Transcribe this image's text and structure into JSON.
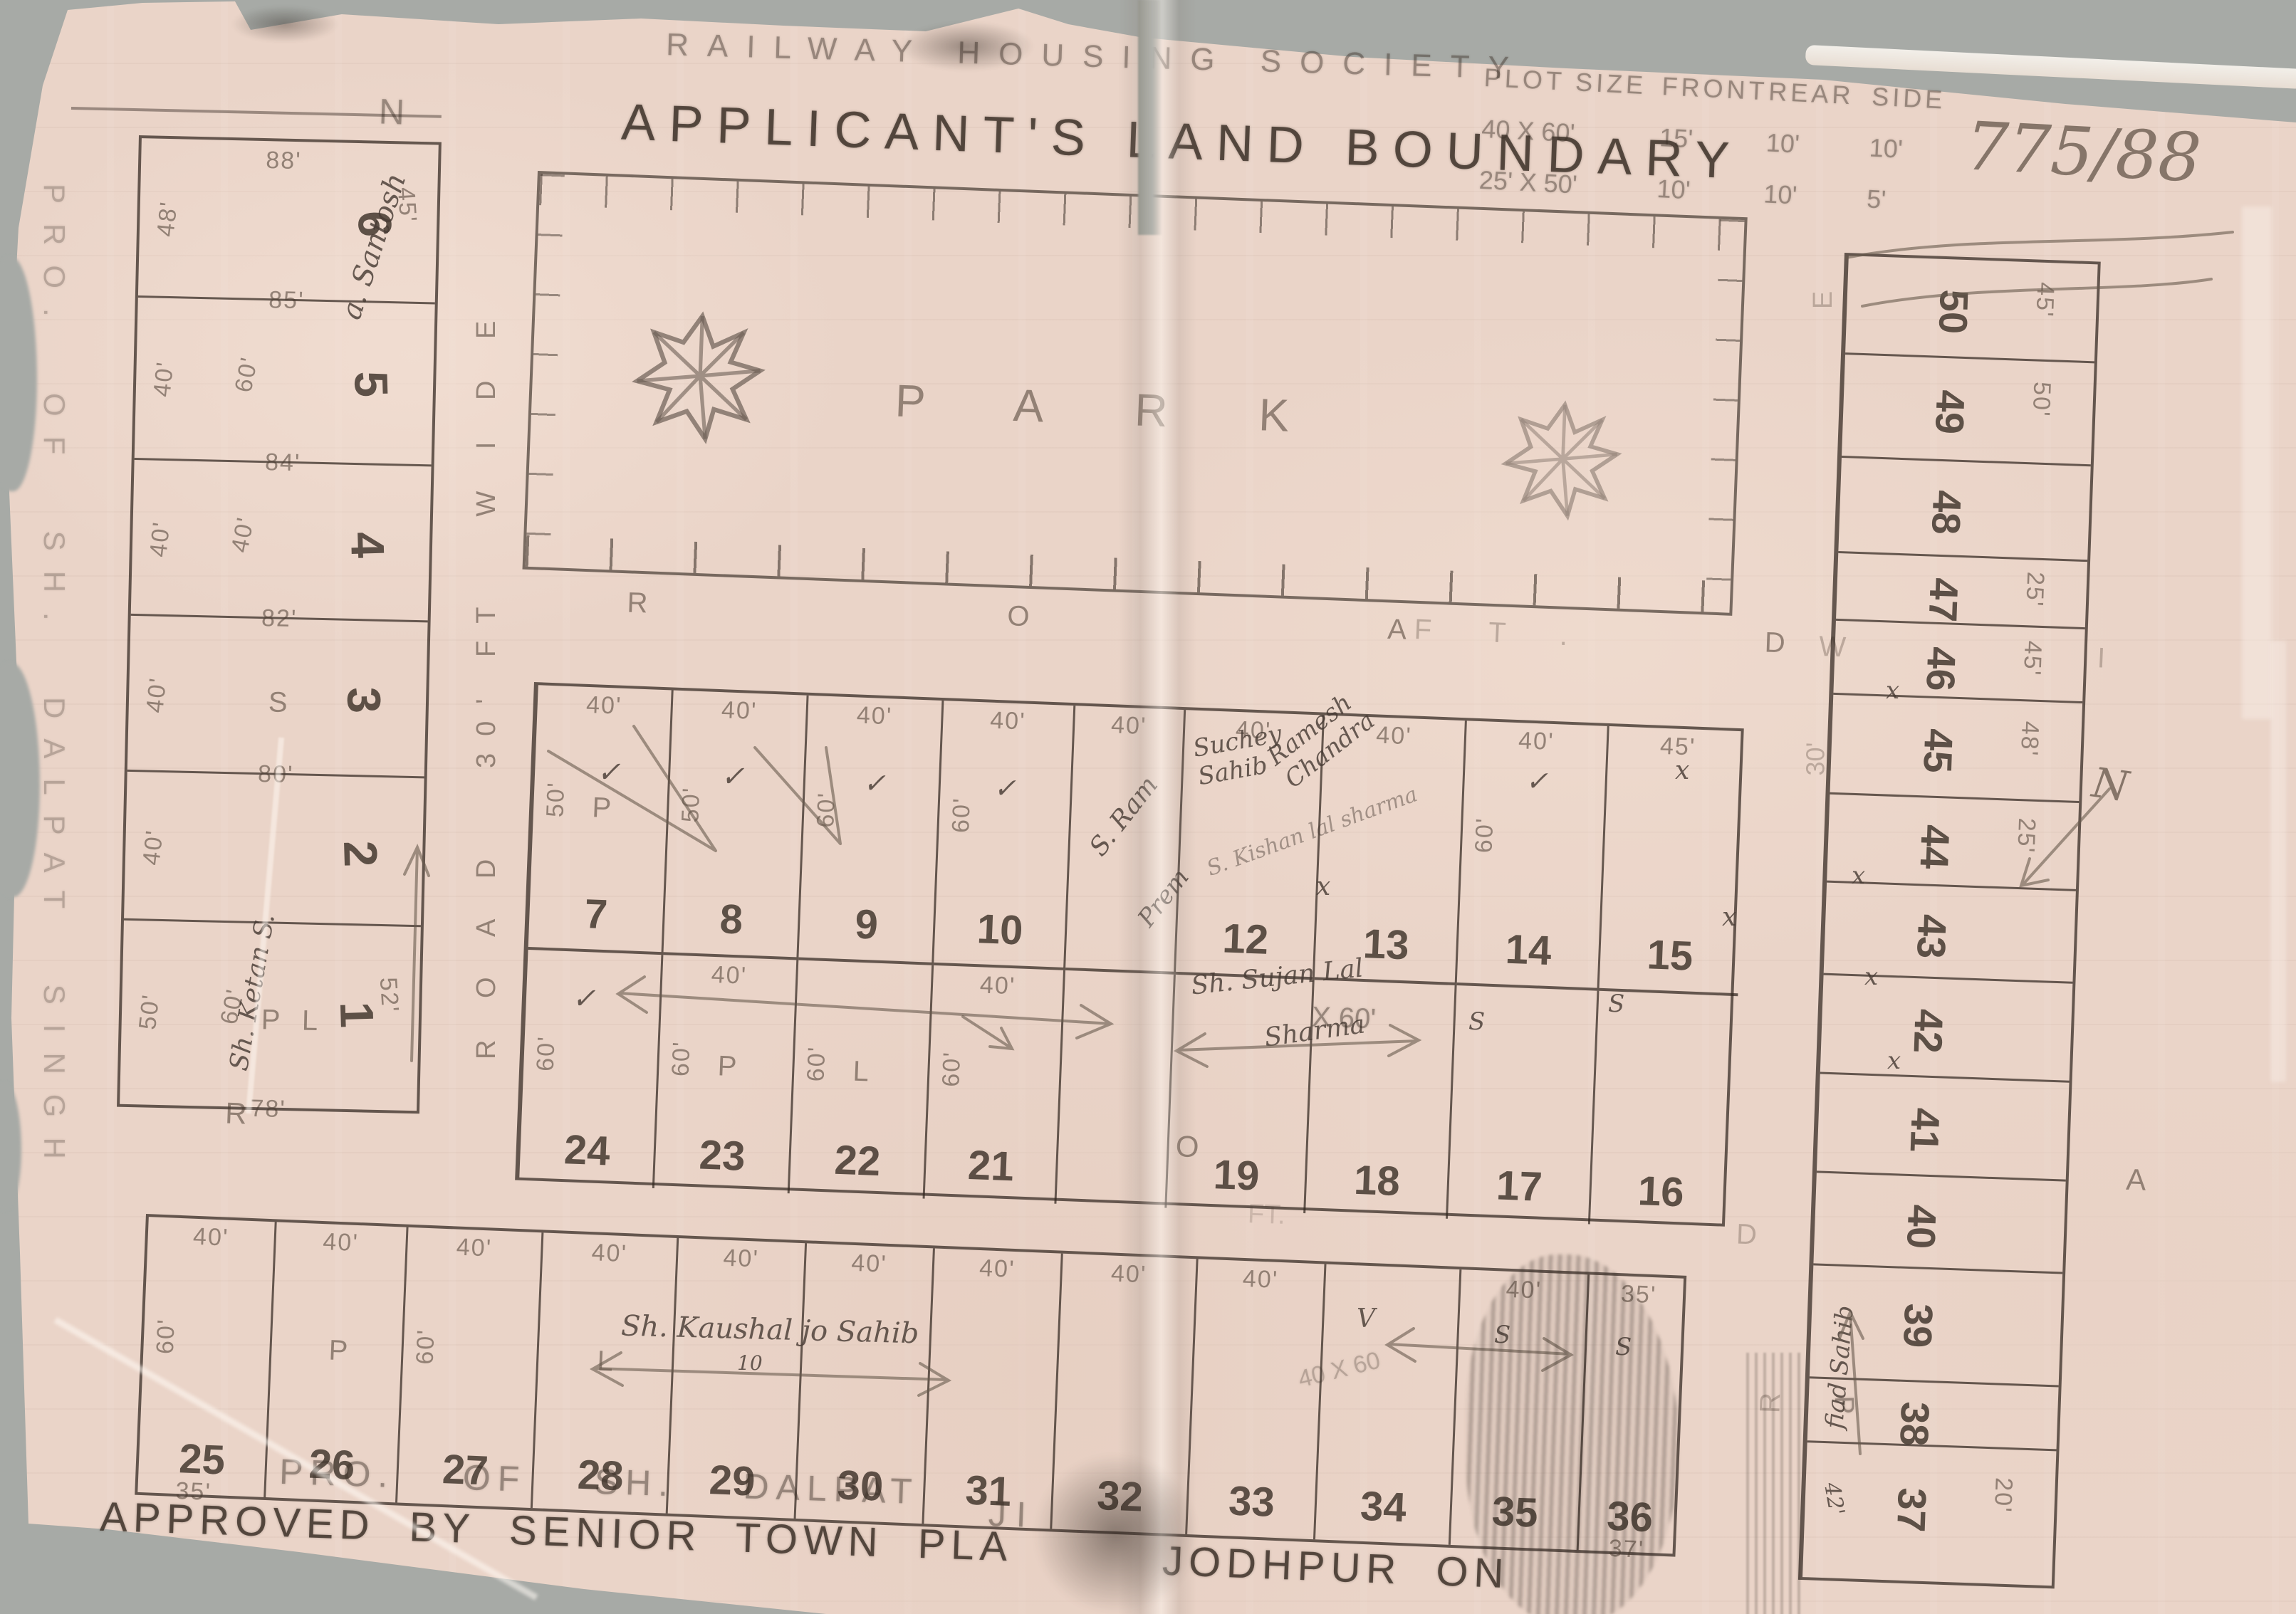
{
  "header": {
    "society": "RAILWAY HOUSING SOCIETY",
    "title": "APPLICANT'S LAND BOUNDARY",
    "ref_number": "775/88",
    "north_letter": "N",
    "size_table": {
      "col_headers": [
        "PLOT SIZE",
        "FRONT",
        "REAR",
        "SIDE"
      ],
      "rows": [
        [
          "40 X 60'",
          "15'",
          "10'",
          "10'"
        ],
        [
          "25' X 50'",
          "10'",
          "10'",
          "5'"
        ]
      ]
    }
  },
  "park": {
    "label": "PARK"
  },
  "roads": {
    "west": "R O A D   30' FT   W I D E",
    "park_south_left": "R   O   A   D",
    "park_south_right": "FT.   W   I   D   E",
    "south": "R         O         A         D",
    "south_ft": "FT.",
    "south_d": "D",
    "east_e": "E",
    "east_30": "30'",
    "east_r": "R"
  },
  "left_block": {
    "rows": [
      {
        "num": "6",
        "side": "45'",
        "top": "88'",
        "left": "48'",
        "bottom": "85'"
      },
      {
        "num": "5",
        "left": "40'",
        "mid": "60'",
        "bottom": "84'"
      },
      {
        "num": "4",
        "left": "40'",
        "mid": "40'",
        "bottom": "82'"
      },
      {
        "num": "3",
        "left": "40'",
        "letter": "S",
        "bottom": "80'"
      },
      {
        "num": "2",
        "left": "40'"
      },
      {
        "num": "1",
        "side": "52'",
        "left": "50'",
        "letter": "P L",
        "mid": "60'",
        "bottom": "78'"
      }
    ]
  },
  "mid_block": {
    "cells": [
      {
        "num": "7",
        "top": "40'",
        "side": "50'",
        "letter": "P"
      },
      {
        "num": "8",
        "top": "40'",
        "side": "50'"
      },
      {
        "num": "9",
        "top": "40'",
        "side": "60'"
      },
      {
        "num": "10",
        "top": "40'",
        "side": "60'"
      },
      {
        "num": "",
        "top": "40'"
      },
      {
        "num": "12",
        "top": "40'"
      },
      {
        "num": "13",
        "top": "40'"
      },
      {
        "num": "14",
        "top": "40'",
        "side": "60'"
      },
      {
        "num": "15",
        "top": "45'"
      },
      {
        "num": "24",
        "side": "60'"
      },
      {
        "num": "23",
        "top": "40'",
        "side": "60'",
        "letter": "P"
      },
      {
        "num": "22",
        "side": "60'",
        "letter": "L"
      },
      {
        "num": "21",
        "top": "40'",
        "side": "60'"
      },
      {
        "num": ""
      },
      {
        "num": "19"
      },
      {
        "num": "18"
      },
      {
        "num": "17"
      },
      {
        "num": "16"
      }
    ]
  },
  "bottom_block": {
    "cells": [
      {
        "num": "25",
        "top": "40'",
        "side": "60'",
        "sub": "35'"
      },
      {
        "num": "26",
        "top": "40'",
        "letter": "P"
      },
      {
        "num": "27",
        "top": "40'",
        "side": "60'"
      },
      {
        "num": "28",
        "top": "40'",
        "letter": "L"
      },
      {
        "num": "29",
        "top": "40'"
      },
      {
        "num": "30",
        "top": "40'"
      },
      {
        "num": "31",
        "top": "40'"
      },
      {
        "num": "32",
        "top": "40'"
      },
      {
        "num": "33",
        "top": "40'"
      },
      {
        "num": "34"
      },
      {
        "num": "35",
        "top": "40'"
      },
      {
        "num": "36",
        "top": "35'",
        "sub": "37'"
      }
    ]
  },
  "right_block": {
    "cells": [
      {
        "num": "50",
        "dim": "45'"
      },
      {
        "num": "49",
        "dim": "50'"
      },
      {
        "num": "48"
      },
      {
        "num": "47",
        "dim": "25'"
      },
      {
        "num": "46",
        "dim": "45'"
      },
      {
        "num": "45",
        "dim": "48'"
      },
      {
        "num": "44",
        "dim": "25'"
      },
      {
        "num": "43"
      },
      {
        "num": "42"
      },
      {
        "num": "41"
      },
      {
        "num": "40"
      },
      {
        "num": "39"
      },
      {
        "num": "38"
      },
      {
        "num": "37",
        "dim": "20'"
      }
    ]
  },
  "stamps": {
    "left_edge": "PRO.  OF  SH.  DALPAT  SINGH",
    "owner_left": "PRO.    OF    SH.    DALPAT",
    "owner_right": "JI",
    "approved_left": "APPROVED  BY  SENIOR  TOWN  PLA",
    "approved_right": "JODHPUR  ON"
  },
  "notes": {
    "santosh": "a. Santosh",
    "ketan": "Sh. Ketan S.",
    "sram": "S. Ram",
    "prem": "Prem",
    "suchey": "Suchey Sahib",
    "ramesh": "Ramesh Chandra",
    "kishan": "S. Kishan lal sharma",
    "sujan1": "Sh. Sujan Lal",
    "sujan2": "Sharma",
    "x60": "X 60'",
    "kaushal": "Sh. Kaushal jo Sahib",
    "ten": "10",
    "forty_sixty": "40 X 60",
    "fiad": "fiad Sahib",
    "p_right": "P",
    "fortytwo": "42'",
    "n_pencil": "N"
  },
  "marks": {
    "check": "✓",
    "cross": "x",
    "letter_s": "S",
    "letter_v": "V"
  }
}
